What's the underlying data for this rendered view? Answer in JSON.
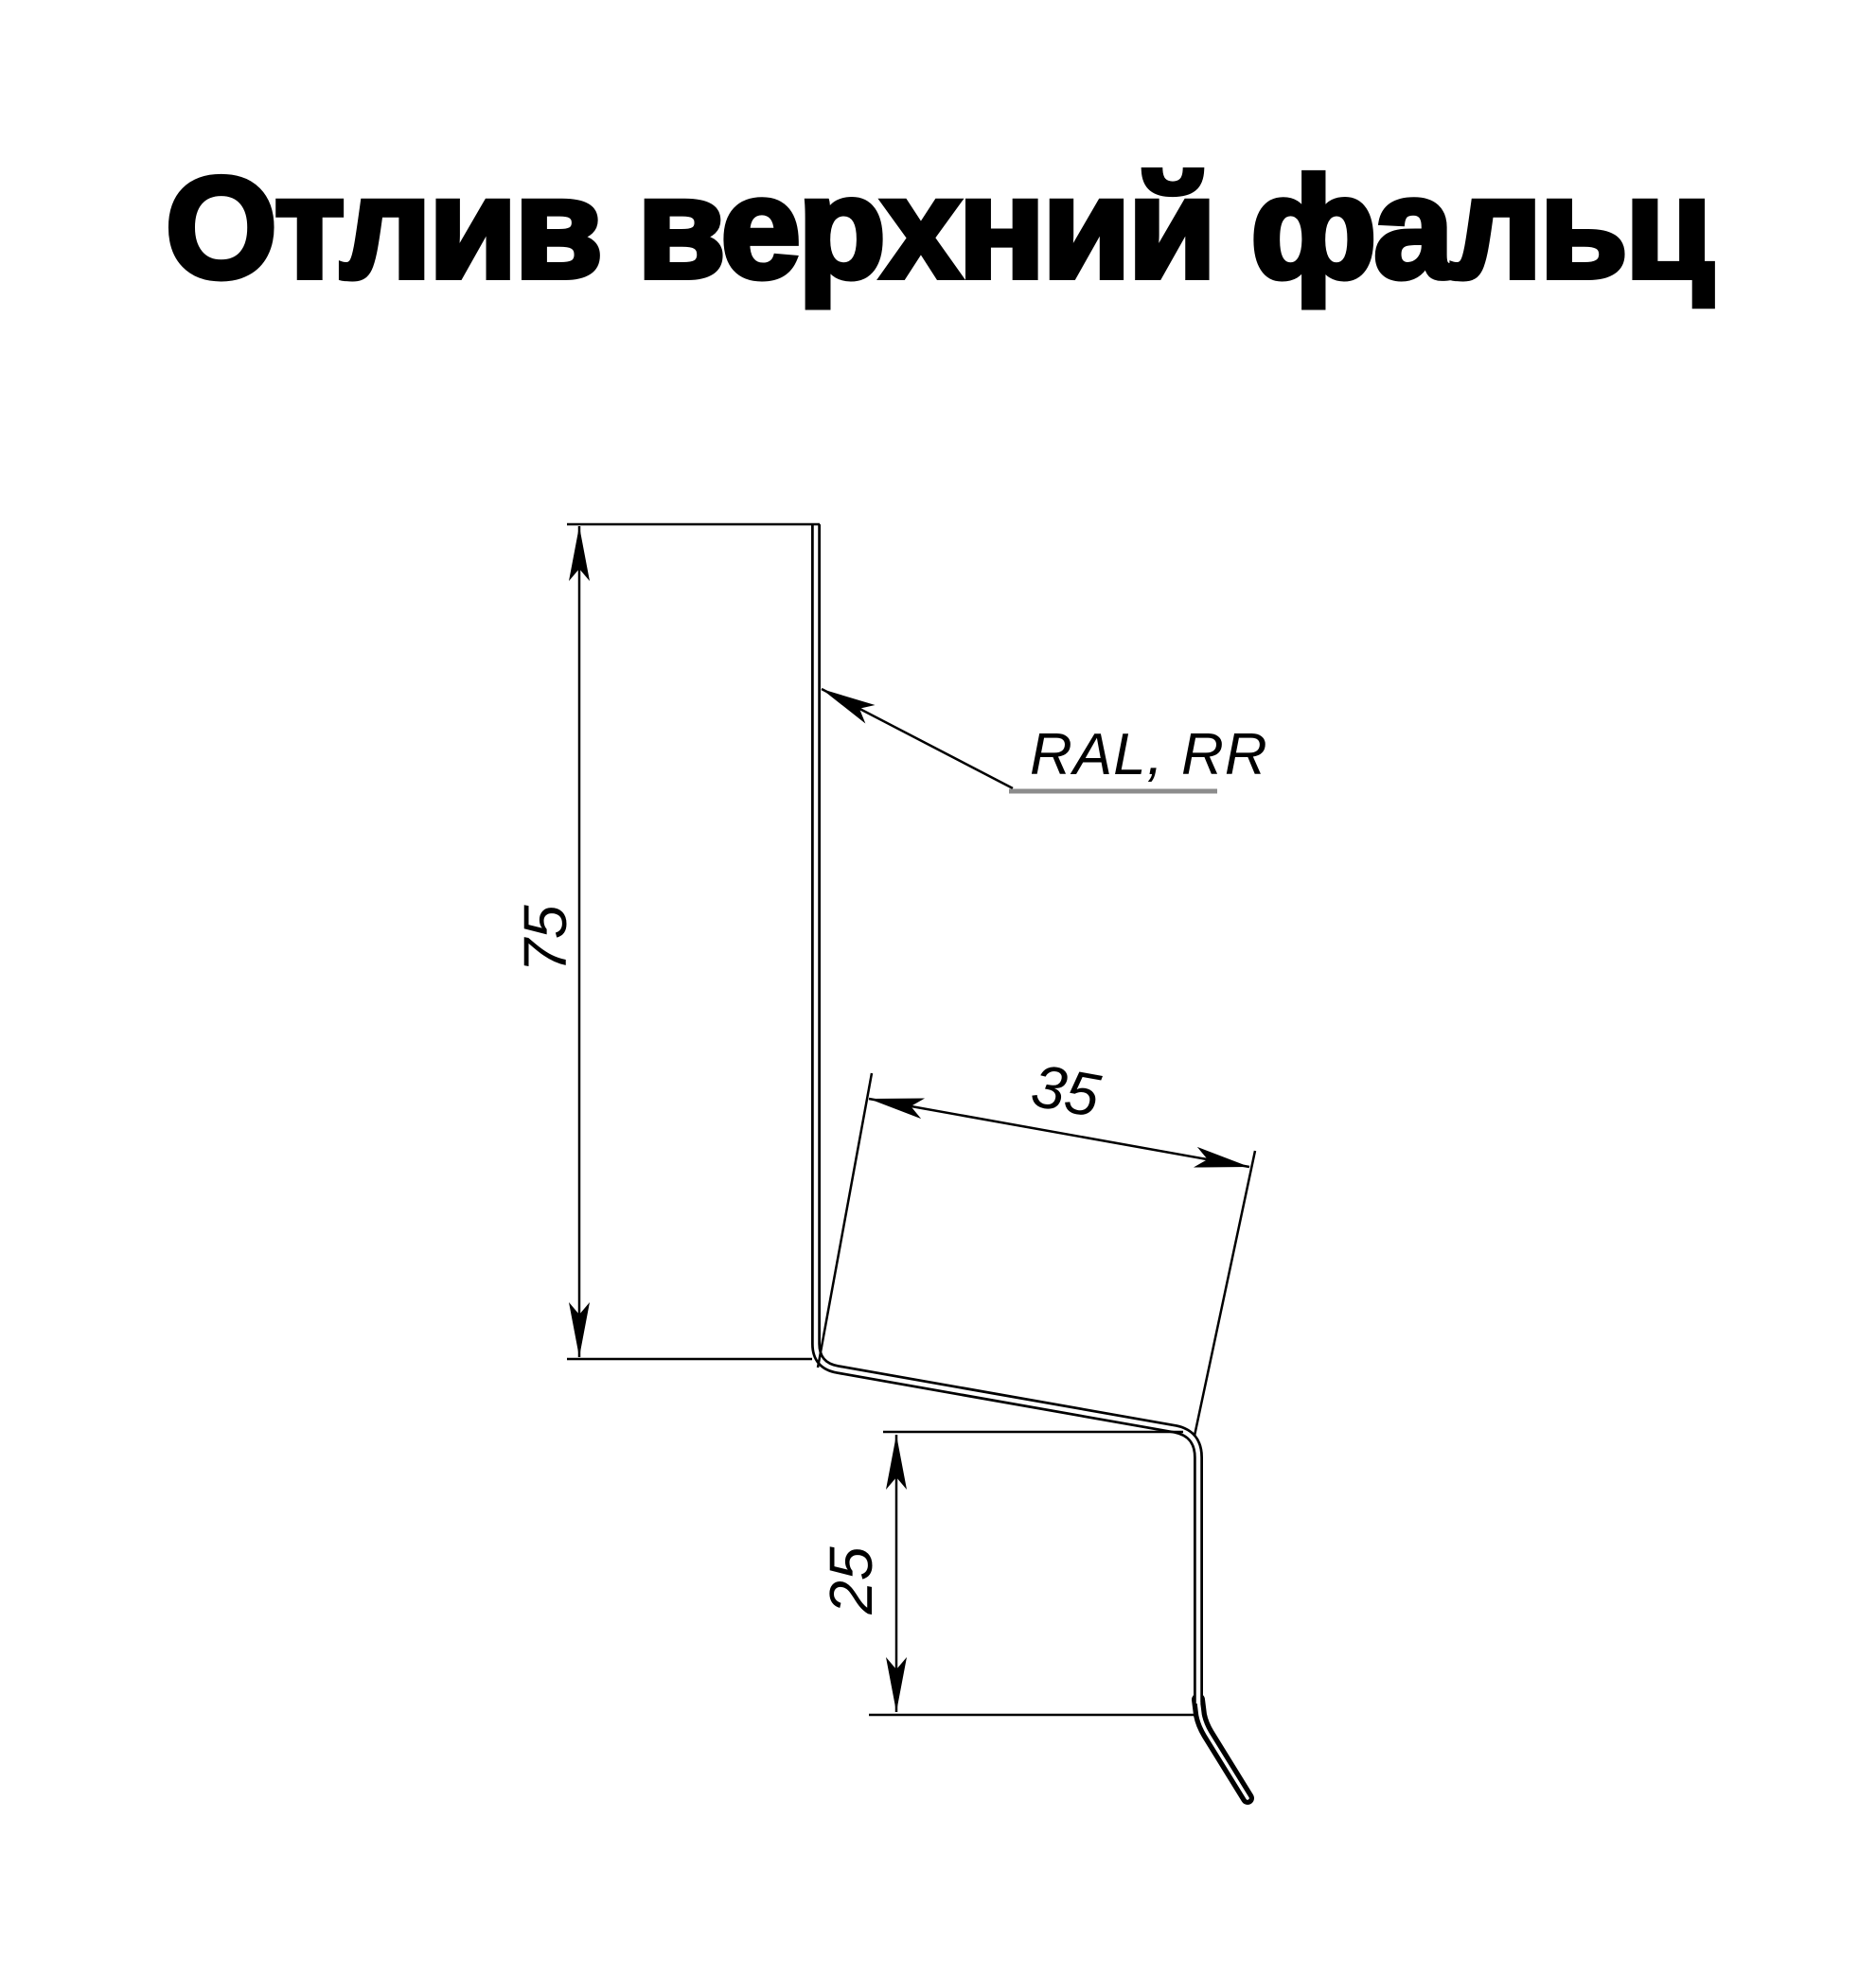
{
  "title": "Отлив верхний фальц",
  "drawing": {
    "material_label": "RAL, RR",
    "dimensions": {
      "face_height": "75",
      "step_width": "35",
      "drop_height": "25"
    },
    "colors": {
      "line": "#000000",
      "leader_underline": "#8c8c8c",
      "background": "#ffffff"
    }
  }
}
